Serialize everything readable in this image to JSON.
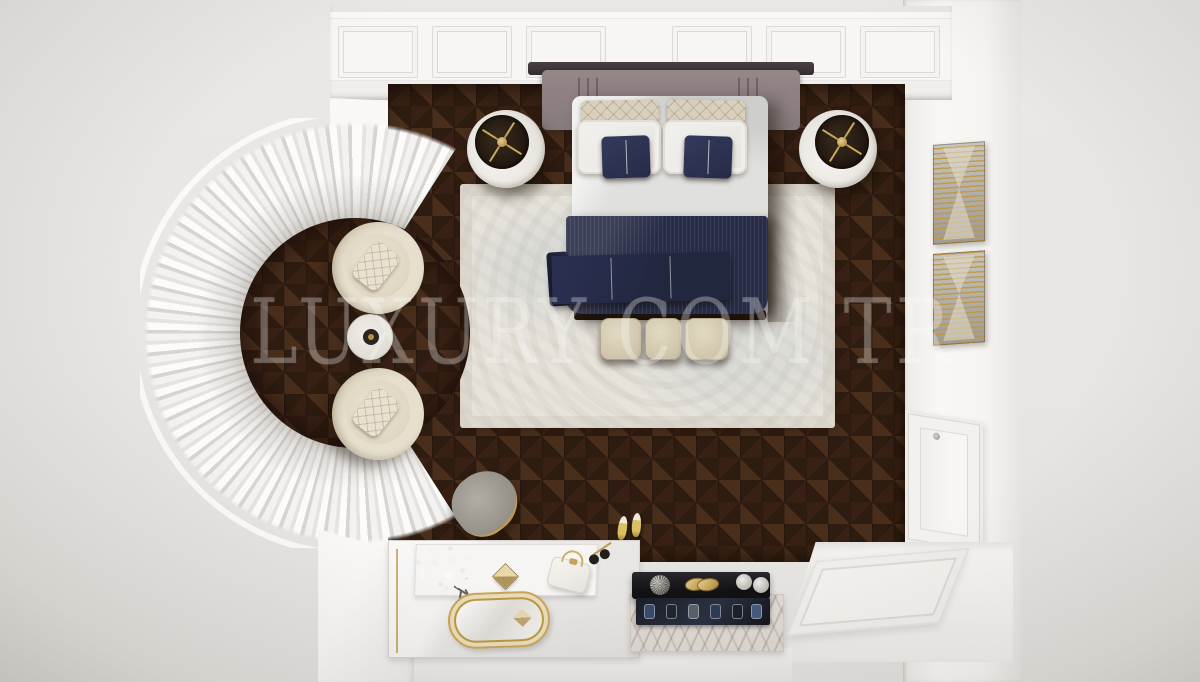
{
  "scene": {
    "description": "Top-down 3D interior render of a luxury bedroom with dark herringbone wood floor, curved curtained bay window, navy bedding and a vanity corner",
    "watermark": {
      "text": "LUXURY COM TR",
      "color": "#ffffff",
      "opacity": 0.26
    },
    "palette": {
      "outside_floor": "#e8e6e3",
      "wall_white": "#f7f6f4",
      "wood_dark": "#2f1c11",
      "wood_mid": "#5f3c25",
      "rug": "#e7e3da",
      "navy_bedding": "#272c47",
      "duvet_white": "#e0e0de",
      "headboard_mauve": "#8d7e80",
      "cream_upholstery": "#d8d0bd",
      "gold_accent": "#c19f52",
      "marble": "#ddd8d2",
      "console_black": "#1a191d",
      "stool_gray": "#948f86"
    },
    "objects": [
      {
        "name": "bay-window-curtains",
        "label": "Curved bay window with white pleated curtains"
      },
      {
        "name": "armchair-top",
        "label": "Round cream armchair with quilted pillow"
      },
      {
        "name": "armchair-bottom",
        "label": "Round cream armchair with quilted pillow"
      },
      {
        "name": "side-table",
        "label": "Round side table with candle"
      },
      {
        "name": "bed",
        "label": "Double bed with white duvet and navy pinstripe bedding"
      },
      {
        "name": "headboard",
        "label": "Mauve upholstered geometric headboard"
      },
      {
        "name": "nightstand-left",
        "label": "Round white nightstand with gold lamp"
      },
      {
        "name": "nightstand-right",
        "label": "Round white nightstand with gold lamp"
      },
      {
        "name": "foot-bench",
        "label": "Bench with three beige cushions"
      },
      {
        "name": "area-rug",
        "label": "Light patterned area rug"
      },
      {
        "name": "wood-floor",
        "label": "Dark herringbone parquet floor"
      },
      {
        "name": "wall-art-upper",
        "label": "Gold striped abstract artwork"
      },
      {
        "name": "wall-art-lower",
        "label": "Gold striped abstract artwork"
      },
      {
        "name": "paneled-door",
        "label": "White paneled door"
      },
      {
        "name": "entry-floor",
        "label": "White paneled entry floor"
      },
      {
        "name": "vanity",
        "label": "White vanity with gold mirror tray, flowers, pyramid studs and handbag"
      },
      {
        "name": "vanity-stool",
        "label": "Gray velvet vanity stool"
      },
      {
        "name": "accessory-console",
        "label": "Black console with brooch, mesh ball and round boxes"
      },
      {
        "name": "watch-tray",
        "label": "Dark tray with watches on marble slab"
      },
      {
        "name": "gold-heels",
        "label": "Pair of gold high-heel shoes"
      },
      {
        "name": "sunglasses",
        "label": "Folded sunglasses"
      }
    ]
  }
}
